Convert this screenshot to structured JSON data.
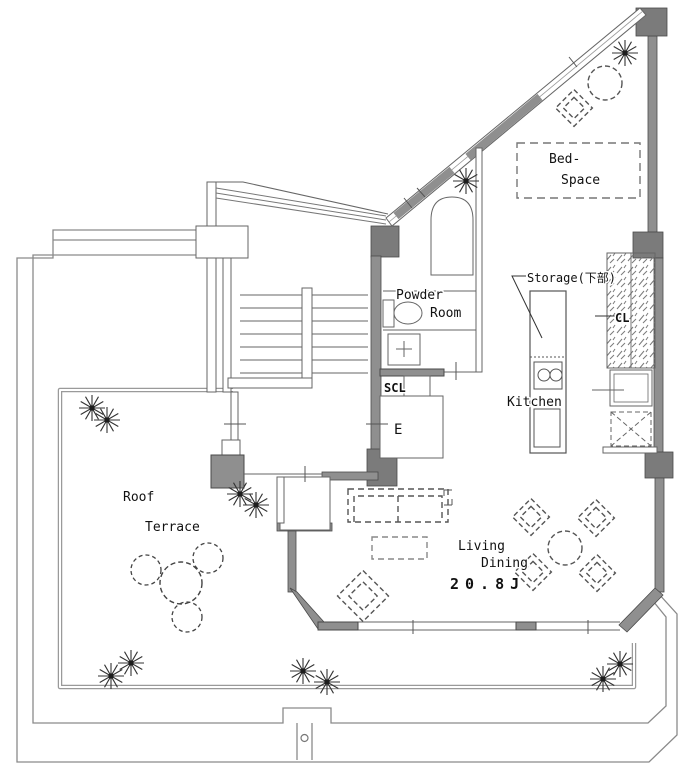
{
  "plan_type": "floor-plan",
  "colors": {
    "background": "#ffffff",
    "wall_gray": "#8f8f8f",
    "wall_dark": "#7b7b7b",
    "line": "#666666",
    "boundary": "#888888",
    "text": "#111111"
  },
  "labels": {
    "bed_space_line1": "Bed-",
    "bed_space_line2": "Space",
    "storage": "Storage(下部)",
    "closet": "CL",
    "powder_line1": "Powder",
    "powder_line2": "Room",
    "kitchen": "Kitchen",
    "shoe_closet": "SCL",
    "elevator": "E",
    "terrace_line1": "Roof",
    "terrace_line2": "Terrace",
    "living_line1": "Living",
    "living_line2": "Dining",
    "living_size": "20.8J"
  }
}
